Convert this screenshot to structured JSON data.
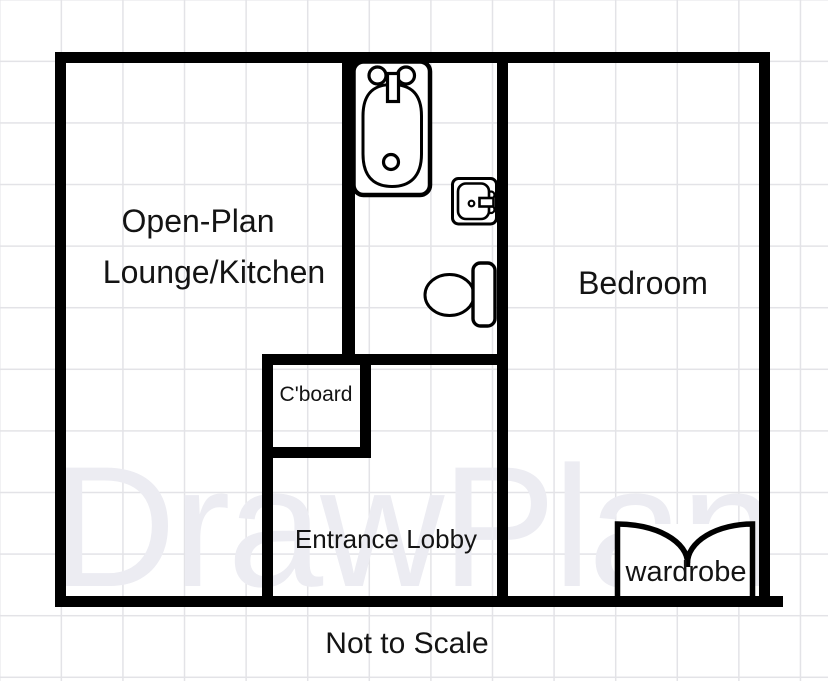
{
  "floor_plan": {
    "watermark": "DrawPlan",
    "scale_note": "Not to Scale",
    "rooms": {
      "lounge": {
        "line1": "Open-Plan",
        "line2": "Lounge/Kitchen"
      },
      "bedroom": {
        "label": "Bedroom"
      },
      "cupboard": {
        "label": "C'board"
      },
      "lobby": {
        "label": "Entrance Lobby"
      },
      "wardrobe": {
        "label": "wardrobe"
      }
    },
    "fixtures": [
      "bathtub",
      "sink",
      "toilet",
      "wardrobe"
    ],
    "colors": {
      "wall": "#000000",
      "text": "#141414",
      "grid_line": "#e3e3e7",
      "watermark": "#ececf2",
      "background": "#ffffff"
    }
  }
}
